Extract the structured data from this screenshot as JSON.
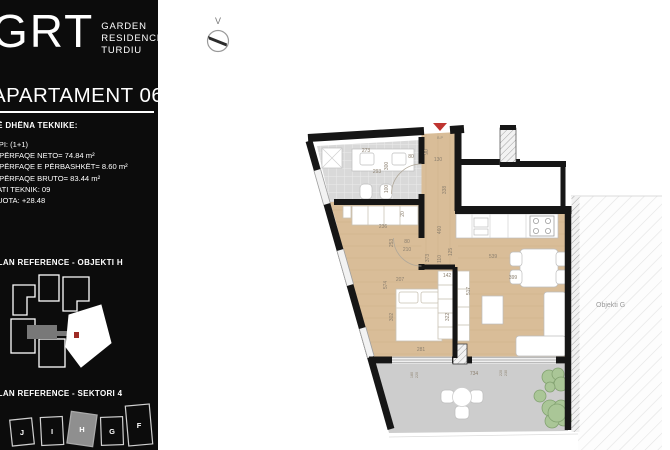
{
  "sidebar": {
    "logo": {
      "brand": "GRT",
      "name_lines": [
        "GARDEN",
        "RESIDENCE",
        "TURDIU"
      ]
    },
    "title": "APARTAMENT 06",
    "tech": {
      "header": "TË DHËNA TEKNIKE:",
      "lines": [
        "TIPI: (1+1)",
        "SIPËRFAQE NETO= 74.84 m²",
        "SIPËRFAQE E PËRBASHKËT= 8.60 m²",
        "SIPËRFAQE BRUTO= 83.44 m²",
        "KATI TEKNIK: 09",
        "KUOTA: +28.48"
      ]
    },
    "ref_objekti": "PLAN REFERENCE - OBJEKTI H",
    "ref_sektori": "PLAN REFERENCE - SEKTORI 4",
    "sector_labels": [
      "J",
      "I",
      "H",
      "G",
      "F"
    ],
    "highlighted_sector": "H"
  },
  "plan": {
    "compass_label": "V",
    "neighbor_label": "Objekti G",
    "entrance_label": "B.P",
    "dims": [
      "273",
      "293",
      "300",
      "100",
      "80",
      "90",
      "130",
      "338",
      "460",
      "373",
      "20",
      "236",
      "253",
      "80",
      "210",
      "110",
      "125",
      "142",
      "574",
      "207",
      "302",
      "322",
      "281",
      "517",
      "539",
      "399",
      "734",
      "180",
      "220",
      "220",
      "230"
    ]
  },
  "colors": {
    "sidebar_bg": "#0c0c0c",
    "wall": "#161616",
    "wood": "#d9bd98",
    "tile": "#d9d9d9",
    "terrace": "#cdcdcd",
    "plant": "#a9c695",
    "accent_red": "#bf3430"
  }
}
